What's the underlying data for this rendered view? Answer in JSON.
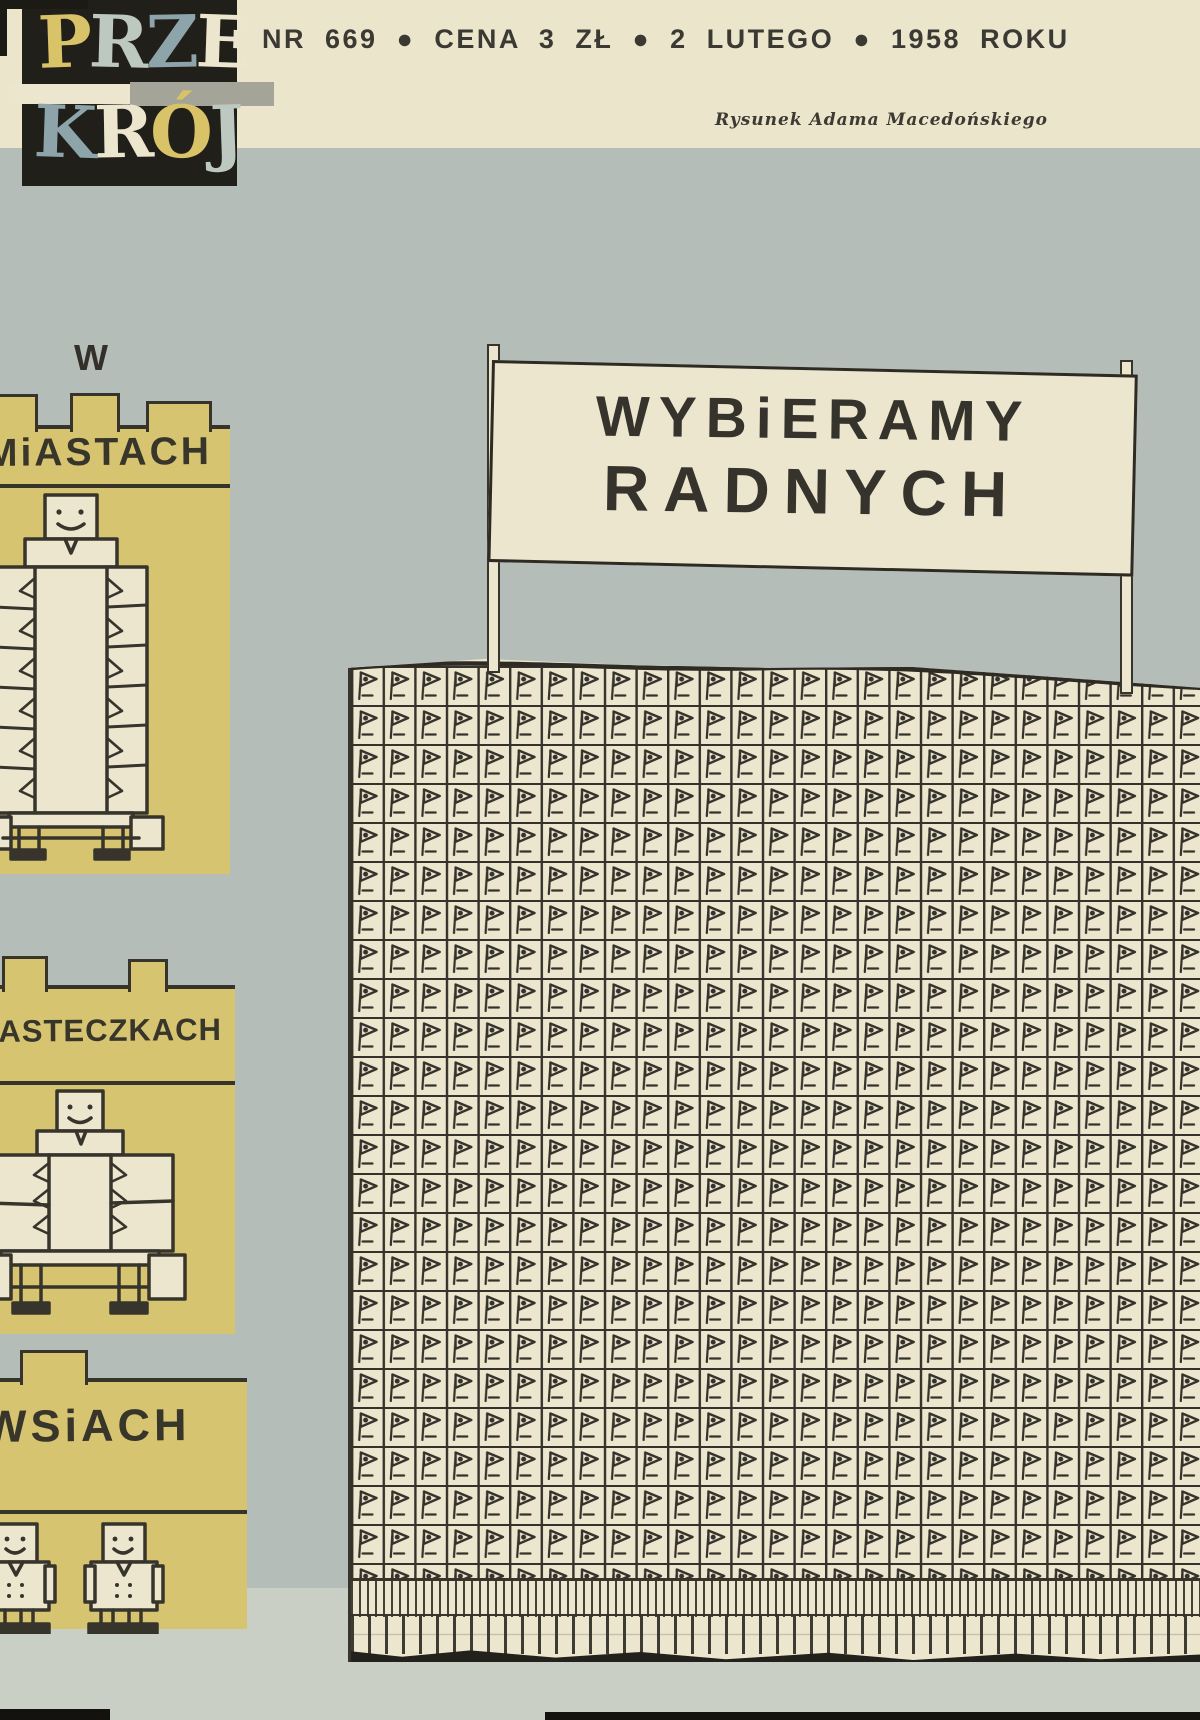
{
  "publication": {
    "logo_letters1": [
      "P",
      "R",
      "Z",
      "E"
    ],
    "logo_letters2": [
      "K",
      "R",
      "Ó",
      "J"
    ],
    "logo_word1": "PRZE",
    "logo_word2": "KRÓJ"
  },
  "header": {
    "issue_line": "NR 669 ● CENA 3 ZŁ ● 2 LUTEGO ● 1958 ROKU",
    "issue_number": "669",
    "price": "3 ZŁ",
    "date": "2 LUTEGO",
    "year": "1958",
    "credit": "Rysunek Adama Macedońskiego"
  },
  "banner": {
    "line1": "WYBiERAMY",
    "line2": "RADNYCH"
  },
  "buildings": {
    "city_prefix": "W",
    "city_label": "MiASTACH",
    "town_label": "MiASTECZKACH",
    "village_label": "WSiACH"
  },
  "colors": {
    "ink": "#37342c",
    "paper": "#ece6cf",
    "cream": "#ebe5cc",
    "sky": "#b5bdb8",
    "ground": "#c9cfc5",
    "yellow": "#d6c470",
    "logo_black": "#211f19",
    "logo_yellow": "#d8c368",
    "logo_steel": "#8ea4ab",
    "logo_gray": "#bcc8c0",
    "bar_gray": "#a5a499"
  }
}
